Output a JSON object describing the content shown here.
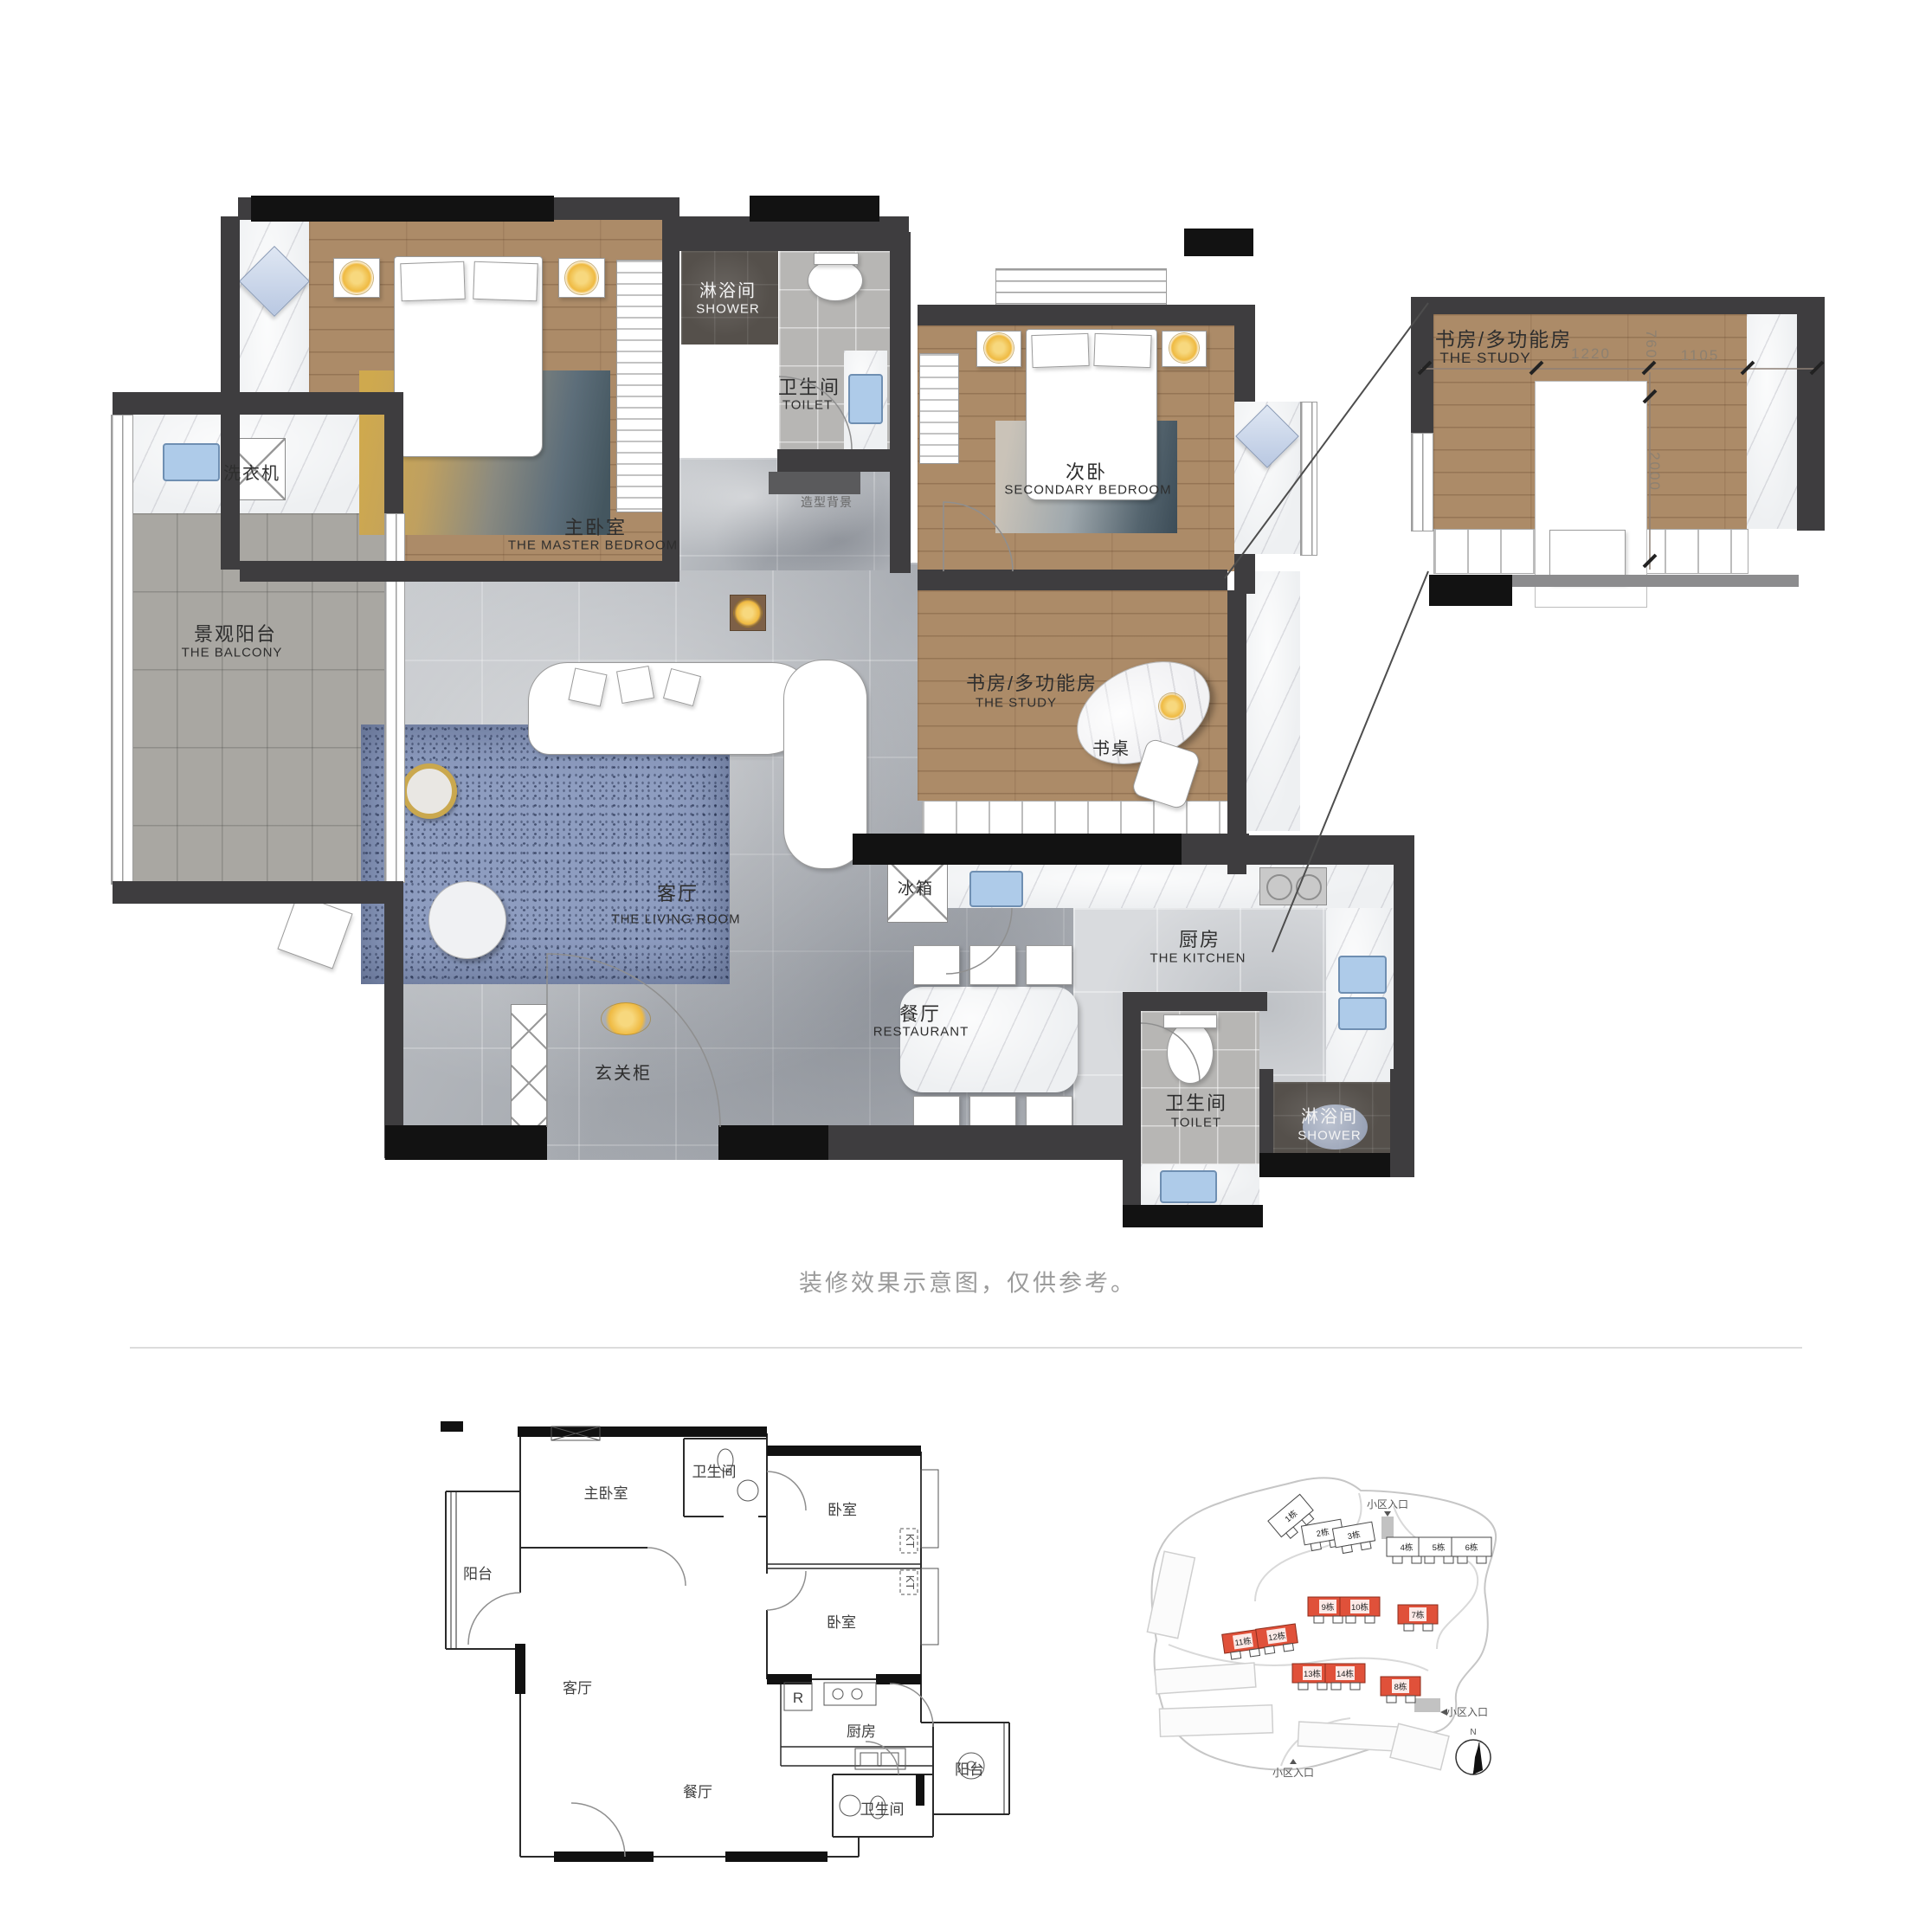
{
  "caption": "装修效果示意图，仅供参考。",
  "colors": {
    "wood": "#ac8b68",
    "wall": "#3e3d3f",
    "wall_black": "#121212",
    "marble_gray": "#b5b8bc",
    "tile_balcony": "#a9a7a2",
    "tile_dark": "#55504b",
    "rug_blue": "#8e9dc0",
    "accent_gold": "#efba42",
    "building_red": "#e0513a",
    "sink_blue": "#aecbe9"
  },
  "main_plan": {
    "rooms": {
      "master_bedroom": {
        "zh": "主卧室",
        "en": "THE MASTER BEDROOM"
      },
      "shower_top": {
        "zh": "淋浴间",
        "en": "SHOWER"
      },
      "toilet_top": {
        "zh": "卫生间",
        "en": "TOILET"
      },
      "secondary_bedroom": {
        "zh": "次卧",
        "en": "SECONDARY BEDROOM"
      },
      "study": {
        "zh": "书房/多功能房",
        "en": "THE STUDY"
      },
      "balcony": {
        "zh": "景观阳台",
        "en": "THE BALCONY"
      },
      "living_room": {
        "zh": "客厅",
        "en": "THE LIVING ROOM"
      },
      "kitchen": {
        "zh": "厨房",
        "en": "THE KITCHEN"
      },
      "restaurant": {
        "zh": "餐厅",
        "en": "RESTAURANT"
      },
      "toilet_bottom": {
        "zh": "卫生间",
        "en": "TOILET"
      },
      "shower_bottom": {
        "zh": "淋浴间",
        "en": "SHOWER"
      }
    },
    "items": {
      "washing_machine": "洗衣机",
      "fridge": "冰箱",
      "entry_cabinet": "玄关柜",
      "desk": "书桌",
      "backdrop": "造型背景"
    }
  },
  "inset": {
    "room_zh": "书房/多功能房",
    "room_en": "THE STUDY",
    "dim_top_left": "1220",
    "dim_top_mid": "760",
    "dim_top_right": "1105",
    "dim_vertical": "2000"
  },
  "cad_plan": {
    "labels": {
      "balcony_left": "阳台",
      "master": "主卧室",
      "bath_top": "卫生间",
      "living": "客厅",
      "bedroom_mid": "卧室",
      "bedroom_bottom": "卧室",
      "dining": "餐厅",
      "kitchen": "厨房",
      "balcony_right": "阳台",
      "bath_bottom": "卫生间",
      "fridge": "R",
      "kt1": "KT",
      "kt2": "KT"
    }
  },
  "site_plan": {
    "entrance_label": "小区入口",
    "north_label": "N",
    "buildings": [
      {
        "label": "1栋",
        "red": false
      },
      {
        "label": "2栋",
        "red": false
      },
      {
        "label": "3栋",
        "red": false
      },
      {
        "label": "4栋",
        "red": false
      },
      {
        "label": "5栋",
        "red": false
      },
      {
        "label": "6栋",
        "red": false
      },
      {
        "label": "7栋",
        "red": true
      },
      {
        "label": "8栋",
        "red": true
      },
      {
        "label": "9栋",
        "red": true
      },
      {
        "label": "10栋",
        "red": true
      },
      {
        "label": "11栋",
        "red": true
      },
      {
        "label": "12栋",
        "red": true
      },
      {
        "label": "13栋",
        "red": true
      },
      {
        "label": "14栋",
        "red": true
      }
    ]
  }
}
